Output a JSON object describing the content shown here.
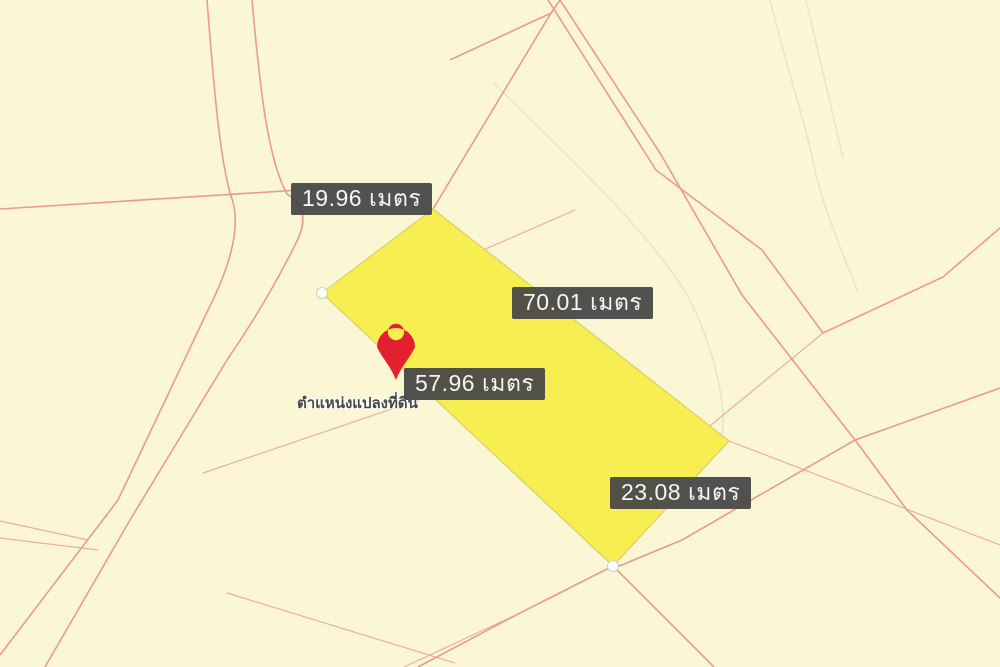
{
  "map": {
    "type": "cadastral-parcel-map",
    "marker_caption": "ตำแหน่งแปลงที่ดิน",
    "measurements": [
      {
        "text": "19.96 เมตร",
        "value": "19.96",
        "unit": "เมตร",
        "side": "northwest"
      },
      {
        "text": "70.01 เมตร",
        "value": "70.01",
        "unit": "เมตร",
        "side": "northeast"
      },
      {
        "text": "57.96 เมตร",
        "value": "57.96",
        "unit": "เมตร",
        "side": "southwest"
      },
      {
        "text": "23.08 เมตร",
        "value": "23.08",
        "unit": "เมตร",
        "side": "southeast"
      }
    ],
    "icons": [
      {
        "name": "map-pin-icon",
        "meaning": "selected parcel location marker"
      },
      {
        "name": "vertex-handle",
        "meaning": "parcel corner point"
      }
    ],
    "colors": {
      "background": "#fbf7d4",
      "parcel_fill": "#f7ee52",
      "parcel_stroke": "#d9cf66",
      "boundary_line": "#ea9b8b",
      "boundary_line_light": "#efae9f",
      "terrain_line": "#e4e6d4",
      "label_background": "#484848",
      "label_text": "#f5f5f5",
      "marker_red": "#e32030",
      "vertex_fill": "#ffffff"
    }
  }
}
